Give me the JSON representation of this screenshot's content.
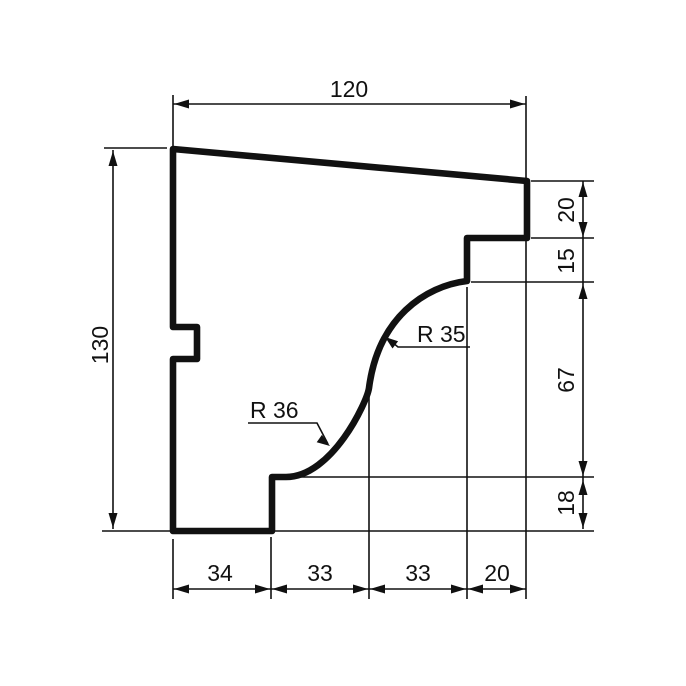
{
  "drawing": {
    "description": "Cornice moulding cross-section profile with dimensions",
    "background_color": "#ffffff",
    "line_color": "#111111",
    "dimensions": {
      "top": {
        "label": "120",
        "value": 120,
        "orientation": "horizontal"
      },
      "left": {
        "label": "130",
        "value": 130,
        "orientation": "vertical"
      },
      "right": [
        {
          "label": "20",
          "value": 20
        },
        {
          "label": "15",
          "value": 15
        },
        {
          "label": "67",
          "value": 67
        },
        {
          "label": "18",
          "value": 18
        }
      ],
      "bottom": [
        {
          "label": "34",
          "value": 34
        },
        {
          "label": "33",
          "value": 33
        },
        {
          "label": "33",
          "value": 33
        },
        {
          "label": "20",
          "value": 20
        }
      ],
      "radii": [
        {
          "label": "R 35",
          "value": 35
        },
        {
          "label": "R 36",
          "value": 36
        }
      ]
    }
  }
}
